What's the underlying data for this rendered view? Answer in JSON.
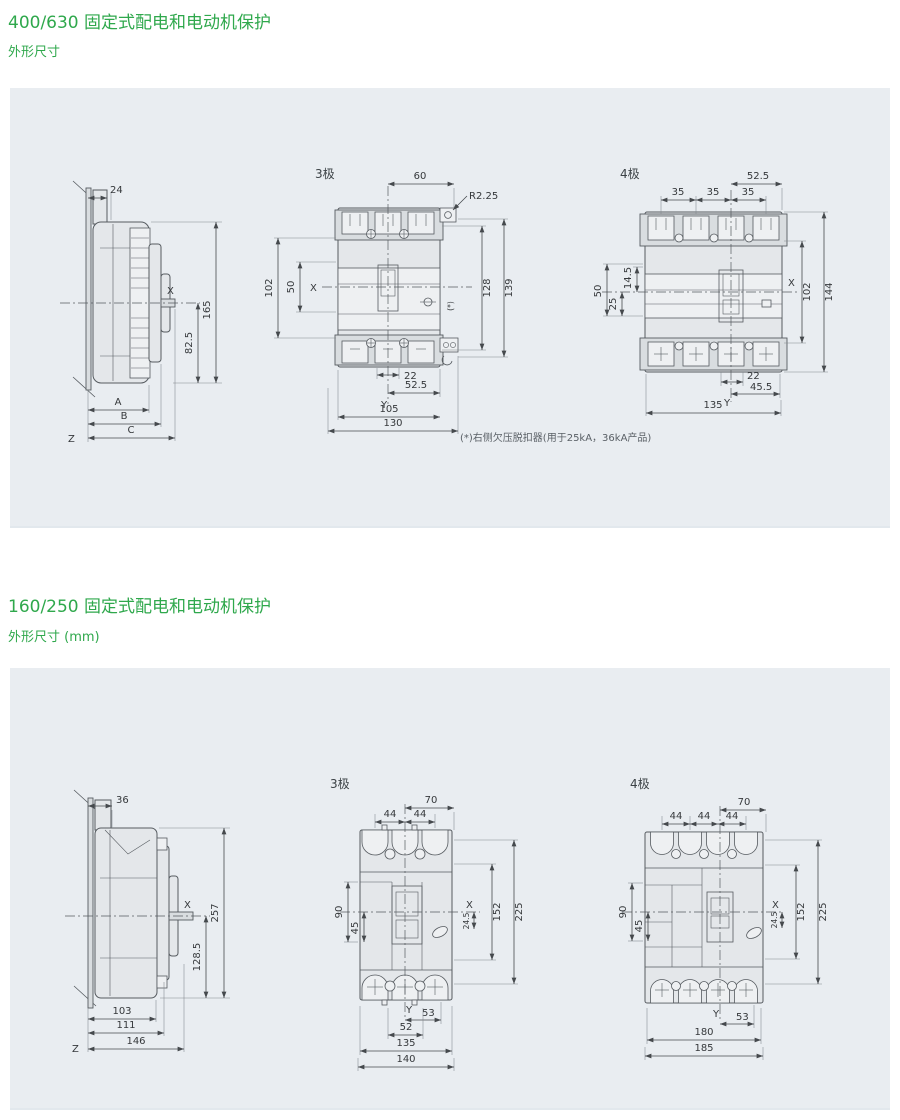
{
  "page": {
    "accent_green": "#2fa84c",
    "panel_bg": "#e9edf1"
  },
  "section1": {
    "title": "400/630 固定式配电和电动机保护",
    "subtitle": "外形尺寸",
    "footnote": "(*)右侧欠压脱扣器(用于25kA，36kA产品)",
    "side": {
      "dim_24": "24",
      "dim_165": "165",
      "dim_825": "82.5",
      "dim_a": "A",
      "dim_b": "B",
      "dim_c": "C",
      "axis_x": "X",
      "axis_z": "Z"
    },
    "pole3": {
      "label": "3极",
      "dim_60": "60",
      "dim_r": "R2.25",
      "dim_102": "102",
      "dim_50": "50",
      "axis_x": "X",
      "dim_128": "128",
      "dim_139": "139",
      "star": "(*)",
      "dim_22": "22",
      "dim_525": "52.5",
      "axis_y": "Y",
      "dim_105": "105",
      "dim_130": "130"
    },
    "pole4": {
      "label": "4极",
      "dim_525": "52.5",
      "dim_35": "35",
      "dim_50": "50",
      "dim_145": "14.5",
      "dim_25": "25",
      "axis_x": "X",
      "dim_102": "102",
      "dim_144": "144",
      "dim_22": "22",
      "dim_455": "45.5",
      "axis_y": "Y",
      "dim_135": "135"
    }
  },
  "section2": {
    "title": "160/250 固定式配电和电动机保护",
    "subtitle": "外形尺寸 (mm)",
    "side": {
      "dim_36": "36",
      "dim_257": "257",
      "dim_1285": "128.5",
      "dim_103": "103",
      "dim_111": "111",
      "dim_146": "146",
      "axis_x": "X",
      "axis_z": "Z"
    },
    "pole3": {
      "label": "3极",
      "dim_70": "70",
      "dim_44": "44",
      "dim_90": "90",
      "dim_45": "45",
      "axis_x": "X",
      "dim_245": "24.5",
      "dim_152": "152",
      "dim_225": "225",
      "axis_y": "Y",
      "dim_53": "53",
      "dim_52": "52",
      "dim_135": "135",
      "dim_140": "140"
    },
    "pole4": {
      "label": "4极",
      "dim_70": "70",
      "dim_44": "44",
      "dim_90": "90",
      "dim_45": "45",
      "axis_x": "X",
      "dim_245": "24.5",
      "dim_152": "152",
      "dim_225": "225",
      "axis_y": "Y",
      "dim_53": "53",
      "dim_180": "180",
      "dim_185": "185"
    }
  }
}
